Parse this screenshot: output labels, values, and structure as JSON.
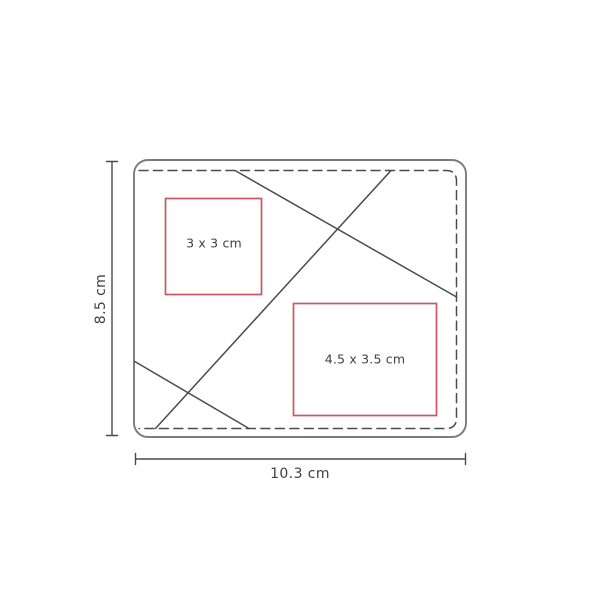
{
  "colors": {
    "background": "#ffffff",
    "outline_gray": "#7a7b7e",
    "line_dark": "#4a4b4d",
    "accent_red": "#cf5560",
    "text_dark": "#3f4043"
  },
  "diagram": {
    "height_dimension": {
      "label": "8.5 cm"
    },
    "width_dimension": {
      "label": "10.3 cm"
    },
    "print_areas": [
      {
        "label": "3 x 3 cm"
      },
      {
        "label": "4.5 x 3.5 cm"
      }
    ]
  }
}
